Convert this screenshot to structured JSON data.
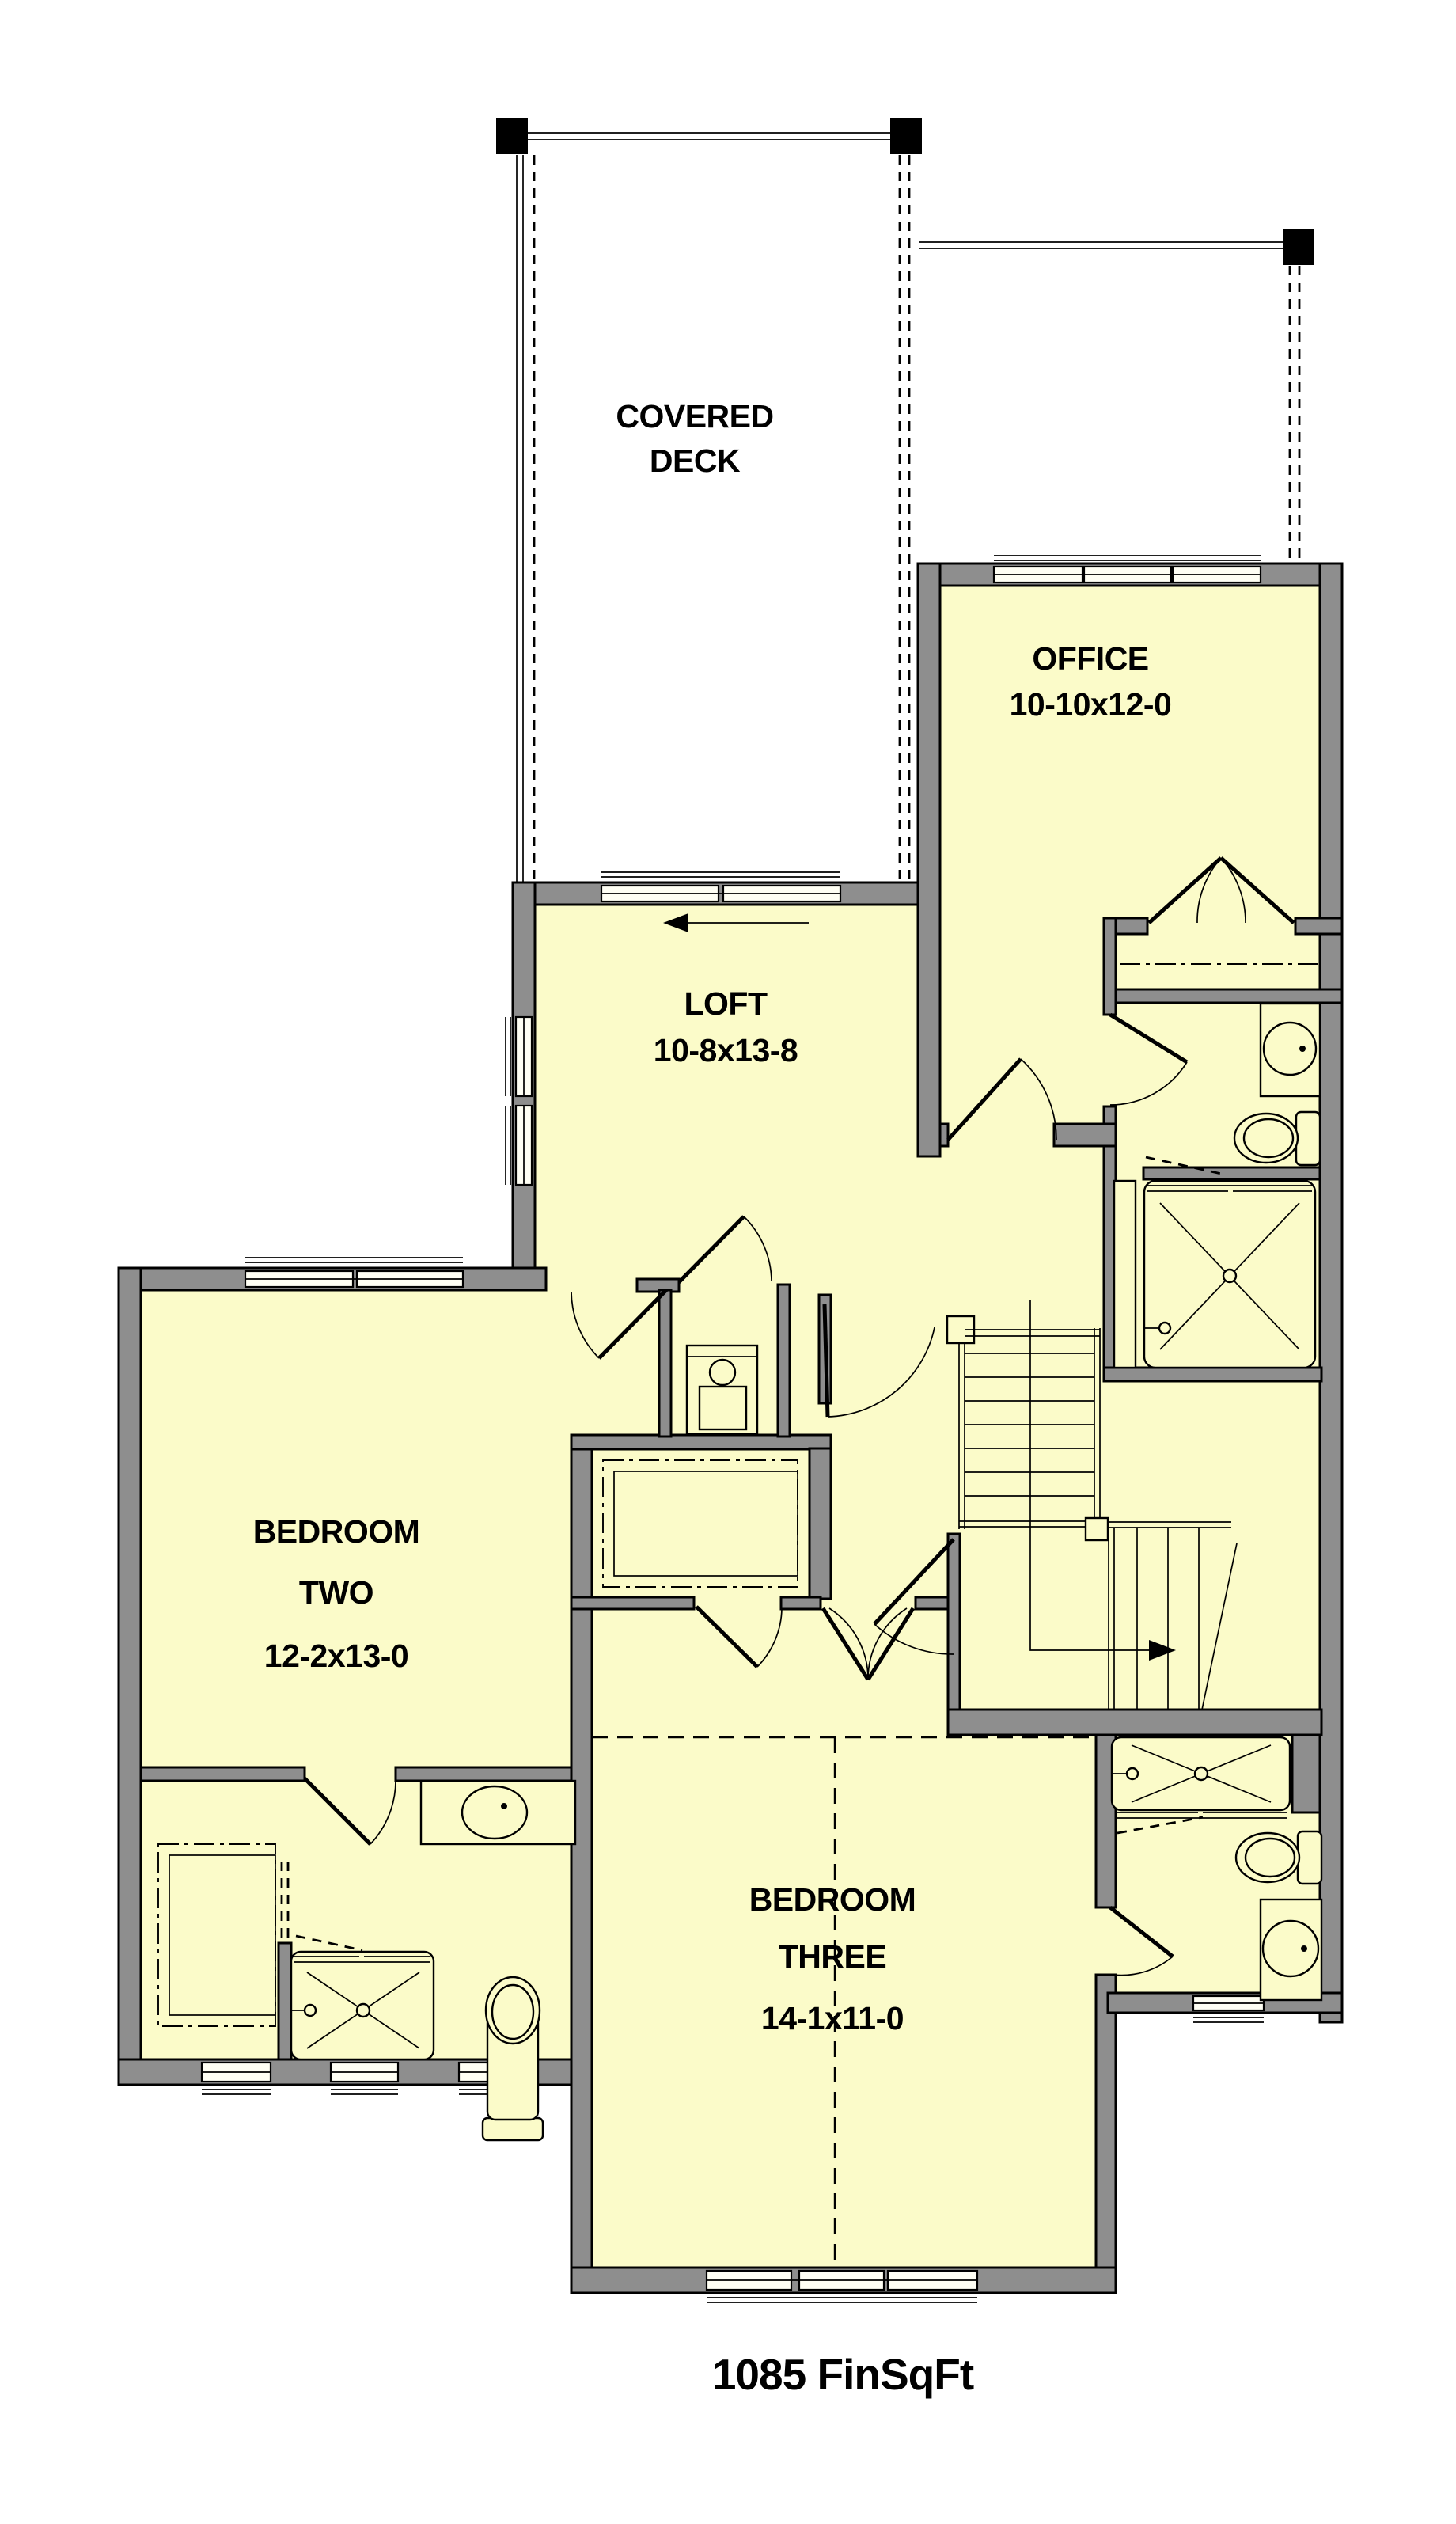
{
  "colors": {
    "floor": "#FBFBC9",
    "wall": "#8E8E8E",
    "outline": "#000000",
    "exterior": "#FFFFFF"
  },
  "rooms": {
    "covered_deck": {
      "line1": "COVERED",
      "line2": "DECK"
    },
    "office": {
      "name": "OFFICE",
      "dims": "10-10x12-0"
    },
    "loft": {
      "name": "LOFT",
      "dims": "10-8x13-8"
    },
    "bedroom_two": {
      "line1": "BEDROOM",
      "line2": "TWO",
      "dims": "12-2x13-0"
    },
    "bedroom_three": {
      "line1": "BEDROOM",
      "line2": "THREE",
      "dims": "14-1x11-0"
    }
  },
  "footer": {
    "area_label": "1085 FinSqFt"
  },
  "fixtures": {
    "toilets": 3,
    "showers": 3,
    "sinks": 3,
    "laundry": 1,
    "stair_direction": "down-right"
  }
}
